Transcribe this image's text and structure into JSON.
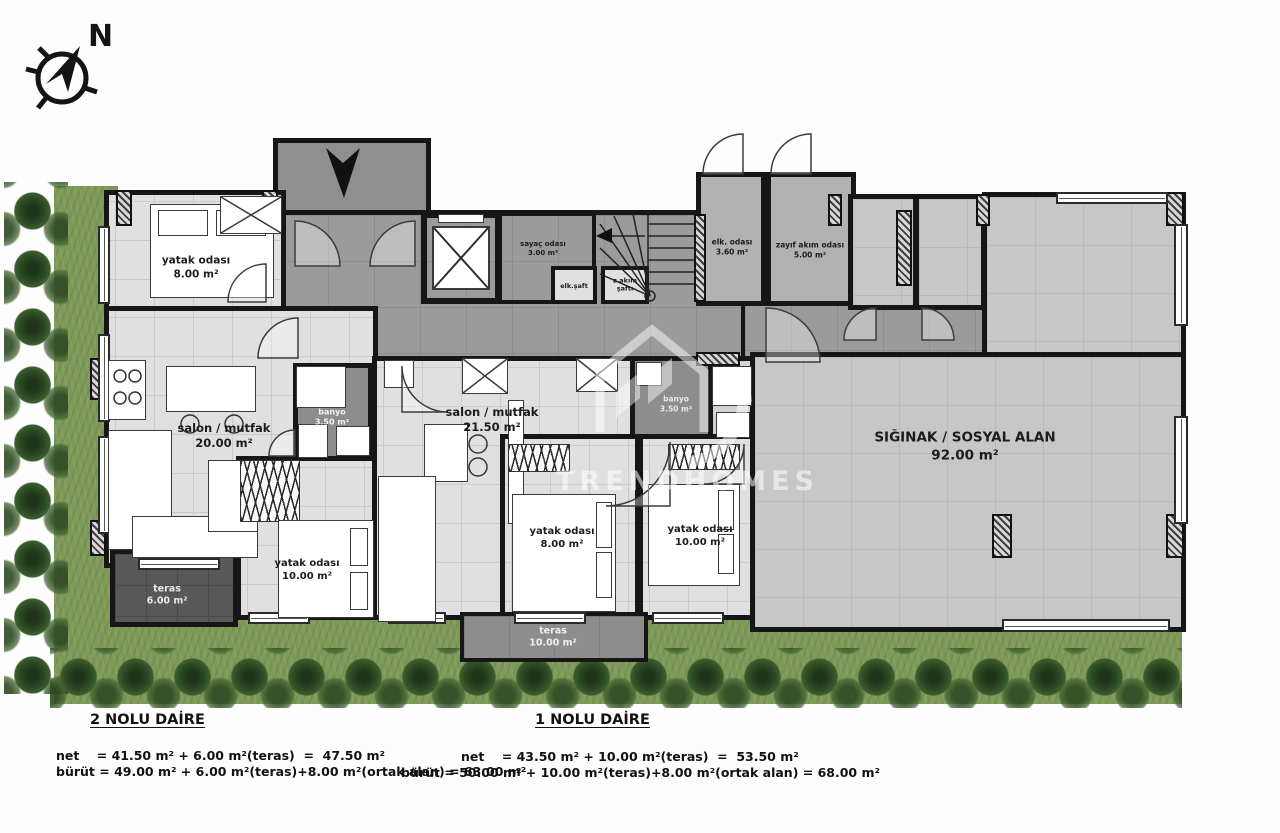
{
  "compass": {
    "north_label": "N"
  },
  "watermark": {
    "text": "TRENDHOMES"
  },
  "rooms": {
    "bedroom_top_left": {
      "name": "yatak odası",
      "area": "8.00 m²"
    },
    "living_kitchen_left": {
      "name": "salon / mutfak",
      "area": "20.00 m²"
    },
    "bathroom_left": {
      "name": "banyo",
      "area": "3.50 m²"
    },
    "bedroom_left": {
      "name": "yatak odası",
      "area": "10.00 m²"
    },
    "terrace_left": {
      "name": "teras",
      "area": "6.00 m²"
    },
    "meter_room": {
      "name": "sayaç odası",
      "area": "3.00 m²"
    },
    "electric_shaft": {
      "name": "elk.şaft"
    },
    "low_current_shaft": {
      "name_line1": "z.akım",
      "name_line2": "şaftı"
    },
    "electric_room": {
      "name": "elk. odası",
      "area": "3.60 m²"
    },
    "low_current_room": {
      "name": "zayıf akım odası",
      "area": "5.00 m²"
    },
    "living_kitchen_mid": {
      "name": "salon / mutfak",
      "area": "21.50 m²"
    },
    "bathroom_mid": {
      "name": "banyo",
      "area": "3.50 m²"
    },
    "bedroom_mid": {
      "name": "yatak odası",
      "area": "8.00 m²"
    },
    "bedroom_right": {
      "name": "yatak odası",
      "area": "10.00 m²"
    },
    "terrace_mid": {
      "name": "teras",
      "area": "10.00 m²"
    },
    "shelter": {
      "name": "SIĞINAK / SOSYAL ALAN",
      "area": "92.00 m²"
    }
  },
  "apartments": {
    "apt2": {
      "title": "2 NOLU DAİRE",
      "net": "net    = 41.50 m² + 6.00 m²(teras)  =  47.50 m²",
      "brut": "bürüt = 49.00 m² + 6.00 m²(teras)+8.00 m²(ortak alan) = 63.00 m²"
    },
    "apt1": {
      "title": "1 NOLU DAİRE",
      "net": "net    = 43.50 m² + 10.00 m²(teras)  =  53.50 m²",
      "brut": "bürüt = 50.00 m² + 10.00 m²(teras)+8.00 m²(ortak alan) = 68.00 m²"
    }
  }
}
